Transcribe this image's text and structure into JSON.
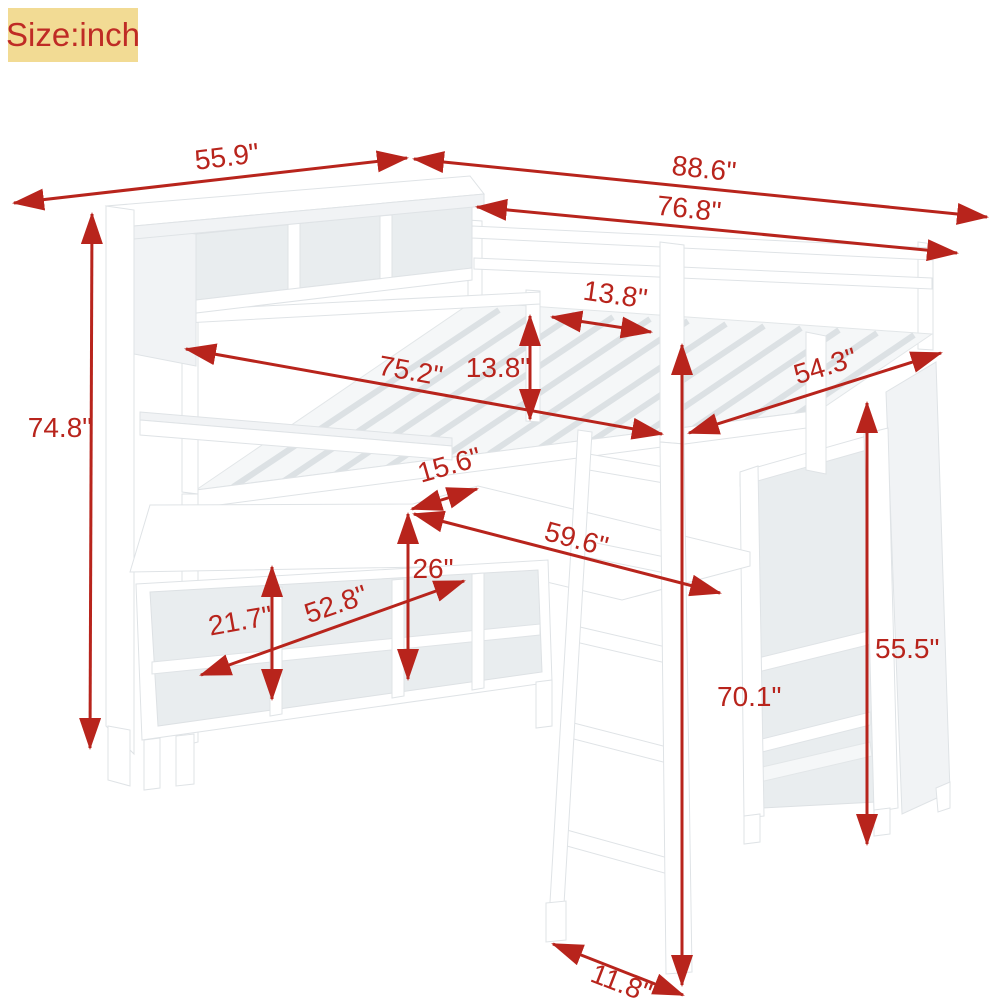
{
  "badge": {
    "label": "Size:inch"
  },
  "unit": "inch",
  "colors": {
    "dimension_red": "#b8241c",
    "badge_background": "#f2db94",
    "badge_text": "#bf2b25",
    "furniture_white": "#ffffff",
    "furniture_shade": "#f1f3f5",
    "furniture_interior": "#e9edef",
    "edge_gray": "#dfe3e6",
    "page_background": "#ffffff"
  },
  "dimensions": [
    {
      "id": "top-shelf-length",
      "label": "55.9\""
    },
    {
      "id": "total-length",
      "label": "88.6\""
    },
    {
      "id": "bed-frame-length",
      "label": "76.8\""
    },
    {
      "id": "ladder-opening-width",
      "label": "13.8\""
    },
    {
      "id": "guardrail-height",
      "label": "13.8\""
    },
    {
      "id": "sleeping-surface-length",
      "label": "75.2\""
    },
    {
      "id": "bed-width",
      "label": "54.3\""
    },
    {
      "id": "total-height",
      "label": "74.8\""
    },
    {
      "id": "desk-return-depth",
      "label": "15.6\""
    },
    {
      "id": "desk-length",
      "label": "59.6\""
    },
    {
      "id": "storage-unit-height",
      "label": "26\""
    },
    {
      "id": "storage-unit-width",
      "label": "52.8\""
    },
    {
      "id": "cubby-opening-height",
      "label": "21.7\""
    },
    {
      "id": "under-bed-clearance",
      "label": "70.1\""
    },
    {
      "id": "wardrobe-height",
      "label": "55.5\""
    },
    {
      "id": "ladder-foot-depth",
      "label": "11.8\""
    }
  ]
}
